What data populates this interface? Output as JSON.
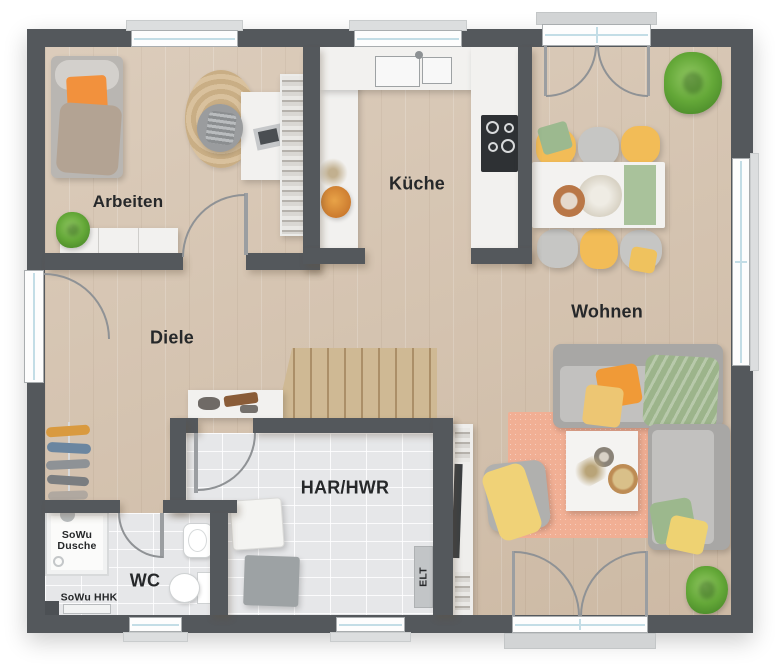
{
  "rooms": {
    "arbeiten": {
      "label": "Arbeiten"
    },
    "kueche": {
      "label": "Küche"
    },
    "wohnen": {
      "label": "Wohnen"
    },
    "diele": {
      "label": "Diele"
    },
    "har_hwr": {
      "label": "HAR/HWR"
    },
    "wc": {
      "label": "WC"
    }
  },
  "annotations": {
    "shower_line1": "SoWu",
    "shower_line2": "Dusche",
    "towel_radiator": "SoWu HHK",
    "electrical": "ELT"
  },
  "palette": {
    "wall": "#54585c",
    "wood_floor": "#d6c4b0",
    "tile_floor": "#e6e7e9",
    "counter_white": "#f2f1ef",
    "sofa_gray": "#b6b5b3",
    "rug_salmon": "#f1af94",
    "chair_yellow": "#f2bc57",
    "pillow_orange": "#f09a37",
    "pillow_green": "#9cb48b",
    "stairs_wood": "#cfb994",
    "plant_green": "#64a838"
  }
}
